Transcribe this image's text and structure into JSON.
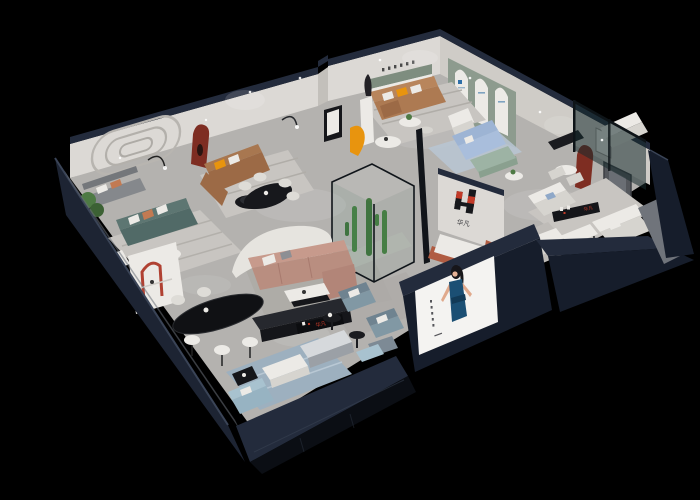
{
  "meta": {
    "type": "3d-render",
    "subject": "Isometric cutaway 3D render of a furniture brand showroom interior at night on a black background",
    "background_color": "#000000"
  },
  "brand": {
    "logo_text": "华凡",
    "logo_mark": "H",
    "logo_red": "#c23a28",
    "logo_dark": "#17181c"
  },
  "signs": {
    "feature_wall_logo_text": "华凡",
    "reception_sign_text": "华凡",
    "shelf_sign_text": "华凡",
    "back_wall_lettering": "······",
    "arch_poster_mark": "H",
    "poster_vertical_text": "·····"
  },
  "poster": {
    "subject": "fashion model in a deep blue dress",
    "panel_color": "#f4f3f1",
    "dress_color": "#1b4f74"
  },
  "palette": {
    "floor": "#b4b2af",
    "interior_wall": "#dcd9d5",
    "wall_top_rim": "#232b3c",
    "exterior_wall": "#1d2433",
    "sage_wall": "#8d9b8e",
    "arch_niche_red": "#7e2d22",
    "sofa_caramel": "#9c6a46",
    "sofa_tan": "#ad7a52",
    "sofa_teal": "#5d7672",
    "sofa_mauve": "#bd9286",
    "sofa_blue": "#a9bedc",
    "sofa_light_blue": "#a8c2cf",
    "accent_orange": "#e8940e",
    "accent_terracotta": "#b05c42",
    "plant_green": "#4e7a44",
    "glass_tint": "#2e4a46"
  },
  "rooms": [
    {
      "id": "lounge-teal",
      "label": "teal sofa lounge with arched wall moulding"
    },
    {
      "id": "lounge-leather",
      "label": "caramel leather sofa lounge with red arch niche"
    },
    {
      "id": "lounge-tan",
      "label": "tan sofa lounge with green niche and arched display wall"
    },
    {
      "id": "lounge-blue",
      "label": "blue sofa lounge behind glass partition"
    },
    {
      "id": "suite-right",
      "label": "white fabric sofa suite with media wall"
    },
    {
      "id": "dining",
      "label": "black oval marble dining table with white chairs"
    },
    {
      "id": "center-gallery",
      "label": "open gallery with mauve sectional and cactus vitrine"
    },
    {
      "id": "storefront",
      "label": "storefront with reception desk, logo sign and model poster"
    }
  ]
}
